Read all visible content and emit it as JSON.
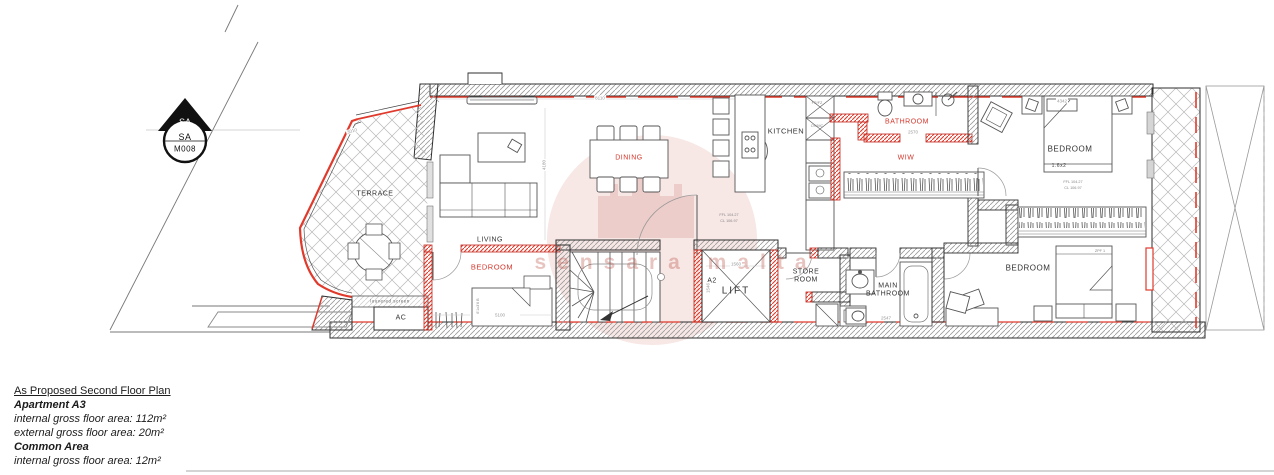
{
  "title_block": {
    "title": "As Proposed Second Floor Plan",
    "apartment_heading": "Apartment A3",
    "apartment_internal": "internal gross floor area: 112m²",
    "apartment_external": "external gross floor area: 20m²",
    "common_heading": "Common Area",
    "common_internal": "internal gross floor area: 12m²"
  },
  "section_marker": {
    "code": "SA",
    "number": "M008"
  },
  "watermark": {
    "text": "sensara malta"
  },
  "rooms": {
    "terrace": "TERRACE",
    "living": "LIVING",
    "dining": "DINING",
    "kitchen": "KITCHEN",
    "bathroom": "BATHROOM",
    "wiw": "WIW",
    "bedroom_master": "BEDROOM",
    "bedroom_front": "BEDROOM",
    "bedroom_back": "BEDROOM",
    "lift": "LIFT",
    "store_room": "STORE ROOM",
    "main_bathroom": "MAIN BATHROOM",
    "ac": "AC"
  },
  "annotations": {
    "entrance_tag": "A2",
    "louvered_screen": "louvered screen",
    "fridge_freezer": "FR/FZ",
    "oven_microwave": "OV/MC",
    "ffl": "FFL 104.27",
    "ceiling_level": "CL 106.97",
    "bed_size_master": "1.6x2",
    "bed_tag": "ZPF 1",
    "bed_size_front": "6'1x3'6 B"
  },
  "dimensions": {
    "living_dining_width": "8110",
    "terrace_edge": "3010",
    "bathroom_width": "2570",
    "bedroom_master_width": "4342",
    "lift_width": "1560",
    "lift_depth": "1546",
    "bedroom_front_width": "5100",
    "main_bathroom_width": "2547",
    "living_depth": "4180"
  },
  "colors": {
    "new_wall_red": "#e03a2c",
    "label_red": "#d6362b",
    "wall_line": "#2f2f2f",
    "hatch_gray": "#9a9a9a",
    "watermark_pink": "#c0392b"
  }
}
